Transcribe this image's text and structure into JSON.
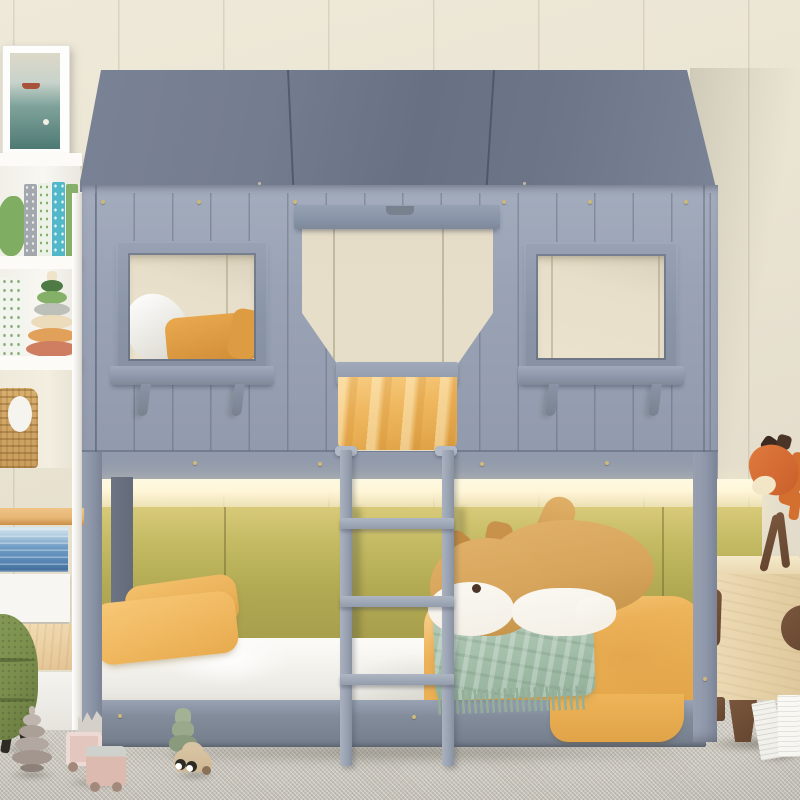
{
  "scene": {
    "type": "product-photo",
    "subject": "gray house-shaped kids bunk bed (twin over twin) in a styled bedroom",
    "objects": {
      "bunk_bed_house": "gray wood house frame with slanted roof, two framed windows with shelves and brackets, open doorway, front guardrail and center ladder with three rungs",
      "upper_bunk": "white pillow and mustard pillows with yellow blanket draped at doorway",
      "lower_bunk": "white mattress, two mustard pillows, apricot duvet, sage fringed blanket, plush shiba dog",
      "headboard_wall": "olive-yellow upholstered panels with warm LED strip glowing under the upper bunk",
      "left_shelf": "white bookcase with framed sea artwork, patterned books, green dinosaur toy, speckled vase, stacking ring toy, wicker basket, wood counter, ocean-print drawer, white drawer, wood drawer",
      "right_nightstand": "light wood cabinet with walnut knob, handle and legs, orange wooden horse lamp on top",
      "floor": "gray woven carpet with wooden toys: gray spiral tree, crown-stack pink truck, green tree, beige car with eyes, open book",
      "ottoman": "green boucle stool at lower-left edge"
    }
  },
  "colors": {
    "wall": "#e9e3d2",
    "carpet": "#cdc9c0",
    "roof": "#6e7689",
    "houseWall": "#9aa3b5",
    "frameGray": "#8a94a7",
    "postGray": "#8d96a8",
    "postDark": "#636b7b",
    "openingCream": "#e7dfca",
    "glow": "#fff6d8",
    "olive": "#b2a953",
    "oliveLit": "#d8ca79",
    "mattressWhite": "#f6f5f0",
    "pillowYellow": "#f0b860",
    "duvetApricot": "#efb65c",
    "blanketSage": "#a8c2ae",
    "dogTan": "#d7a55c",
    "dogCream": "#f3efe6",
    "dogDark": "#4a3526",
    "baseRail": "#828c9b",
    "woodLight": "#e9d6ae",
    "walnut": "#64452f",
    "horseOrange": "#d4702f",
    "ottomanGreen": "#7d914f",
    "treeGray": "#b3a7a1",
    "treeGreen": "#9aa98c",
    "truckPink": "#dcbab0",
    "carBeige": "#cfb893",
    "basketTan": "#c89d5e",
    "counterWood": "#e5b574",
    "oceanBlue": "#5d8cba",
    "bookTeal": "#52b8c9",
    "toyGreen": "#7fae63"
  }
}
